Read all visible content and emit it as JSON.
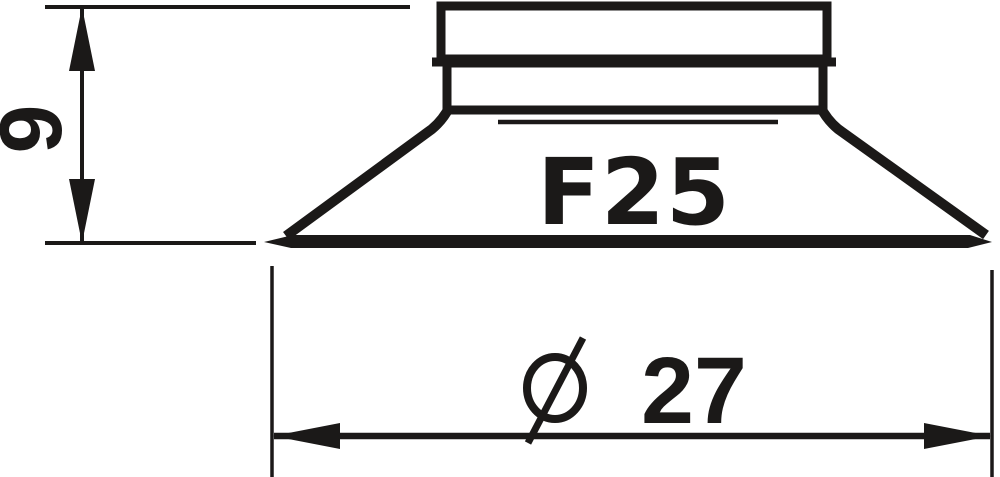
{
  "canvas": {
    "background_color": "#ffffff",
    "ink_color": "#1b1918"
  },
  "drawing": {
    "kind": "suction-cup dimensional drawing",
    "part": {
      "label": "F25"
    },
    "dimensions": {
      "height": {
        "value": "9",
        "orientation": "vertical"
      },
      "diameter": {
        "symbol": "Ø",
        "value": "27",
        "label": "Ø 27",
        "orientation": "horizontal"
      }
    }
  }
}
